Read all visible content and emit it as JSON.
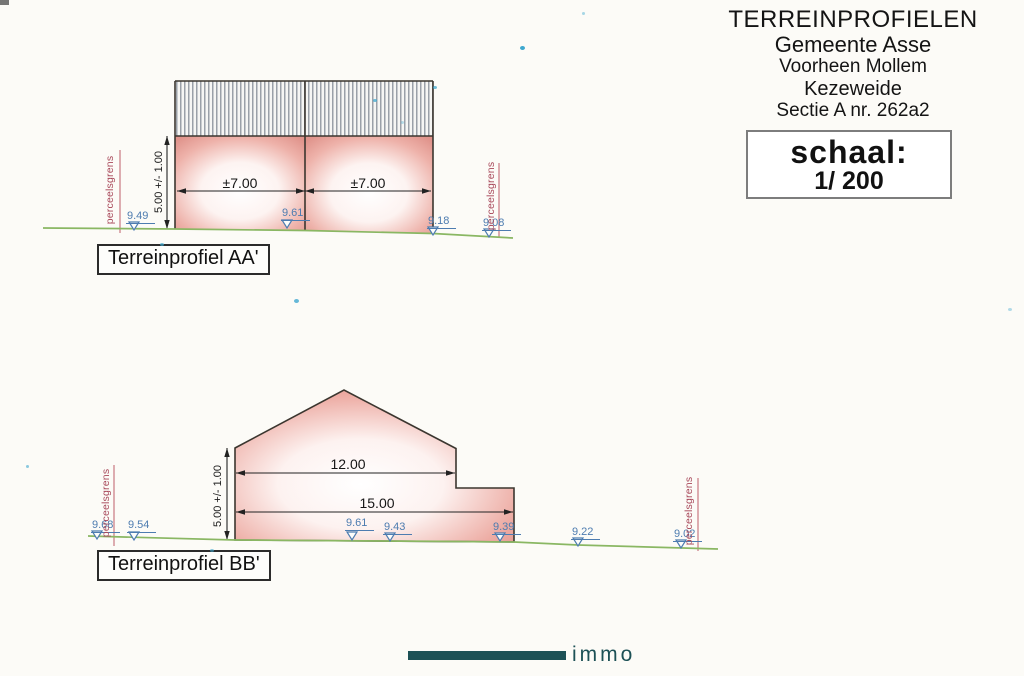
{
  "header": {
    "title": "TERREINPROFIELEN",
    "line2": "Gemeente Asse",
    "line3": "Voorheen Mollem",
    "line4": "Kezeweide",
    "line5": "Sectie A nr. 262a2"
  },
  "scale_box": {
    "label": "schaal:",
    "value": "1/ 200"
  },
  "profile_aa": {
    "title": "Terreinprofiel AA'",
    "width_dims": [
      "±7.00",
      "±7.00"
    ],
    "height_dim": "5.00 +/- 1.00",
    "parcel_label_left": "perceelsgrens",
    "parcel_label_right": "perceelsgrens",
    "elevations": [
      "9.49",
      "9.61",
      "9.18",
      "9.08"
    ]
  },
  "profile_bb": {
    "title": "Terreinprofiel BB'",
    "width_dims": [
      "12.00",
      "15.00"
    ],
    "height_dim": "5.00 +/- 1.00",
    "parcel_label_left": "perceelsgrens",
    "parcel_label_right": "perceelsgrens",
    "elevations": [
      "9.68",
      "9.54",
      "9.61",
      "9.43",
      "9.39",
      "9.22",
      "9.02"
    ]
  },
  "logo": {
    "text": "immo"
  },
  "colors": {
    "wall_edge": "#e0948c",
    "outline": "#3b362f",
    "ground": "#8ab763",
    "elevation_text": "#4d7cb0",
    "parcel_text": "#a8485a",
    "logo_teal": "#1d5156"
  }
}
